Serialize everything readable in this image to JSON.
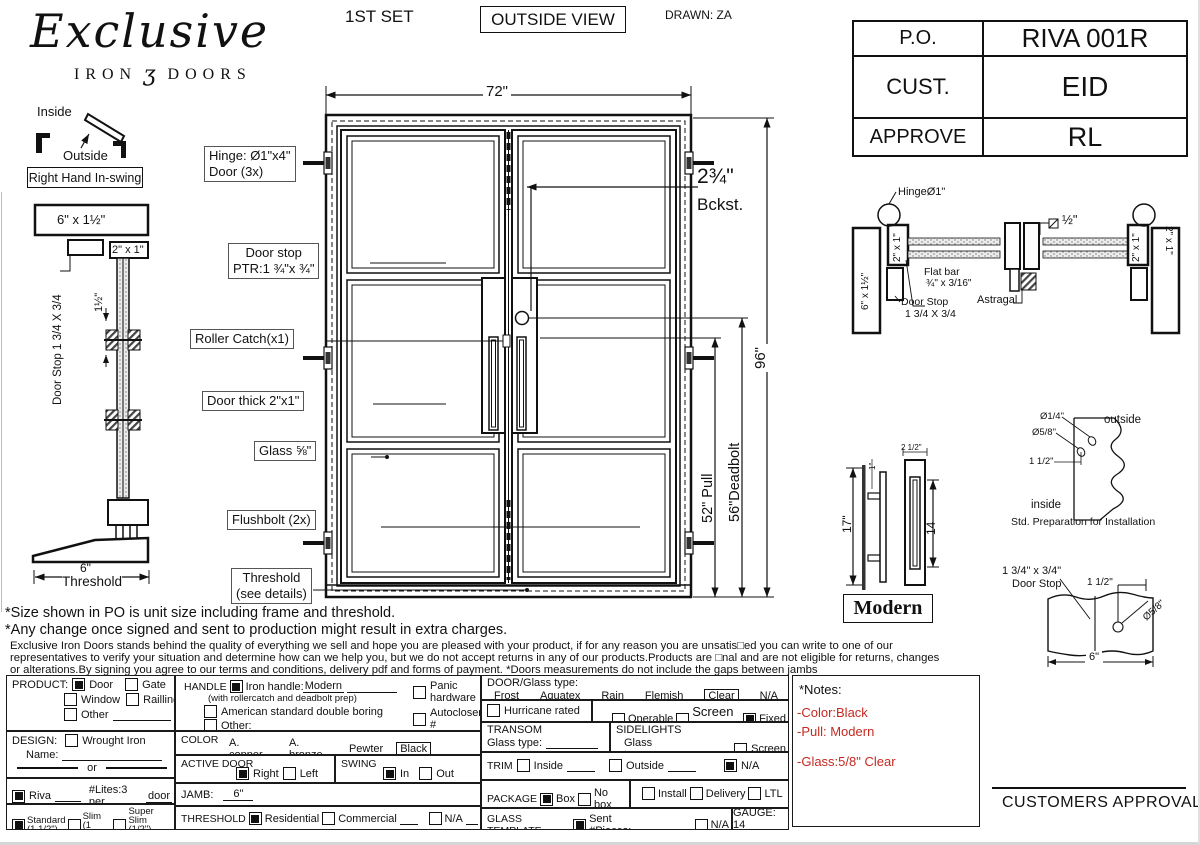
{
  "colors": {
    "accent_red": "#c52a21",
    "ink": "#111111"
  },
  "logo": {
    "name": "Exclusive",
    "sub_left": "IRON",
    "sub_glyph": "ʒ",
    "sub_right": "DOORS"
  },
  "header": {
    "set": "1ST SET",
    "view": "OUTSIDE VIEW",
    "drawn": "DRAWN: ZA"
  },
  "order_table": {
    "rows": [
      {
        "label": "P.O.",
        "value": "RIVA 001R"
      },
      {
        "label": "CUST.",
        "value": "EID"
      },
      {
        "label": "APPROVE",
        "value": "RL"
      }
    ]
  },
  "swing_diagram": {
    "inside": "Inside",
    "outside": "Outside",
    "caption": "Right Hand In-swing"
  },
  "side_profile": {
    "head_dim": "6\" x 1½\"",
    "stile_dim": "2\" x 1\"",
    "door_stop": "Door Stop 1 3/4 X 3/4",
    "stop_gap": "1½\"",
    "threshold_width": "6\"",
    "threshold_label": "Threshold"
  },
  "elevation": {
    "width": "72\"",
    "height": "96\"",
    "pull": "52\" Pull",
    "deadbolt": "56\"Deadbolt",
    "backset_value": "2¾\"",
    "backset_label": "Bckst.",
    "callouts": {
      "hinge_line1": "Hinge: Ø1\"x4\"",
      "hinge_line2": "Door (3x)",
      "door_stop_line1": "Door stop",
      "door_stop_line2": "PTR:1 ¾\"x ¾\"",
      "roller_catch": "Roller Catch(x1)",
      "door_thickness": "Door thick 2\"x1\"",
      "glass": "Glass ⅝\"",
      "flushbolt": "Flushbolt (2x)",
      "threshold_line1": "Threshold",
      "threshold_line2": "(see details)"
    }
  },
  "head_detail": {
    "hinge": "HingeØ1\"",
    "left_jamb": "6\" x 1½\"",
    "left_stile": "2\" x 1\"",
    "right_stile": "2\" x 1\"",
    "right_jamb": "2\" x 1\"",
    "gap": "½\"",
    "flat_bar_line1": "Flat bar",
    "flat_bar_line2": "¾\" x 3/16\"",
    "door_stop_line1": "Door Stop",
    "door_stop_line2": "1 3/4 X 3/4",
    "astragal": "Astragal"
  },
  "pull_detail": {
    "height": "17\"",
    "slot_height": "14",
    "width": "2 1/2\"",
    "standoff": "1\"",
    "style": "Modern"
  },
  "prep_detail": {
    "hole_small": "Ø1/4\"",
    "hole_large": "Ø5/8\"",
    "offset": "1 1/2\"",
    "outside": "outside",
    "inside": "inside",
    "caption": "Std. Preparation for Installation"
  },
  "stop_detail": {
    "size": "1 3/4\" x 3/4\"",
    "name": "Door Stop",
    "offset": "1 1/2\"",
    "hole": "Ø5/8\"",
    "width": "6\""
  },
  "disclaimers": {
    "line1": "*Size shown in PO is unit size including frame and threshold.",
    "line2": "*Any change once signed and sent to production might result in extra charges.",
    "para_line1": "Exclusive Iron Doors stands behind the quality of everything we sell and hope you are pleased with your product, if for any reason you are unsatis□ed you can write to one of our",
    "para_line2": "representatives to verify your situation and determine how can we help you, but we do not accept returns in any of our products.Products are □nal and are not eligible for returns, changes",
    "para_line3": "or alterations.By signing you agree to our terms and conditions, delivery pdf and forms of payment. *Doors measurements do not include the gaps between jambs"
  },
  "form": {
    "product": {
      "label": "PRODUCT:",
      "door": {
        "label": "Door",
        "checked": true
      },
      "gate": {
        "label": "Gate",
        "checked": false
      },
      "window": {
        "label": "Window",
        "checked": false
      },
      "railing": {
        "label": "Railling",
        "checked": false
      },
      "other": {
        "label": "Other",
        "checked": false
      }
    },
    "design": {
      "label": "DESIGN:",
      "wrought": {
        "label": "Wrought Iron",
        "checked": false
      },
      "name_label": "Name:",
      "or_label": "or"
    },
    "riva": {
      "check": {
        "label": "Riva",
        "checked": true
      },
      "lites": "#Lites:3 per",
      "lites_ul": "door"
    },
    "profile": {
      "standard": {
        "label": "Standard",
        "sub": "(1 1/2\")",
        "checked": true
      },
      "slim": {
        "label": "Slim",
        "sub": "(1 1/4\")",
        "checked": false
      },
      "super_slim": {
        "label": "Super Slim",
        "sub": "(1/2\") SDL",
        "checked": false
      }
    },
    "handle": {
      "label": "HANDLE",
      "iron": {
        "label": "Iron handle:",
        "value": "Modern",
        "checked": true
      },
      "note": "(with rollercatch and deadbolt prep)",
      "american": {
        "label": "American standard double boring",
        "checked": false
      },
      "other": {
        "label": "Other:",
        "checked": false
      },
      "panic": {
        "label": "Panic hardware",
        "checked": false
      },
      "autocloser": {
        "label": "Autocloser #",
        "checked": false
      },
      "pbar": {
        "label": "P. Bar #",
        "checked": false
      }
    },
    "color": {
      "label": "COLOR",
      "opt1": "A. copper",
      "opt2": "A. bronze",
      "opt3": "Pewter",
      "selected": "Black"
    },
    "active_door": {
      "label": "ACTIVE DOOR",
      "right": {
        "label": "Right",
        "checked": true
      },
      "left": {
        "label": "Left",
        "checked": false
      }
    },
    "swing": {
      "label": "SWING",
      "in": {
        "label": "In",
        "checked": true
      },
      "out": {
        "label": "Out",
        "checked": false
      }
    },
    "jamb": {
      "label": "JAMB:",
      "value": "6\""
    },
    "threshold": {
      "label": "THRESHOLD",
      "residential": {
        "label": "Residential",
        "checked": true
      },
      "commercial": {
        "label": "Commercial",
        "checked": false
      },
      "na": {
        "label": "N/A",
        "checked": false
      }
    },
    "glass_type": {
      "label": "DOOR/Glass type:",
      "opt1": "Frost",
      "opt2": "Aquatex",
      "opt3": "Rain",
      "opt4": "Flemish",
      "selected": "Clear",
      "opt6": "N/A"
    },
    "hurricane": {
      "label": "Hurricane rated",
      "checked": false
    },
    "operable": {
      "label": "Operable",
      "checked": false
    },
    "screen_or": {
      "label": "Screen or",
      "checked": false
    },
    "fixed": {
      "label": "Fixed",
      "checked": true
    },
    "transom": {
      "label": "TRANSOM",
      "glass_label": "Glass type:"
    },
    "sidelights": {
      "label": "SIDELIGHTS",
      "glass_label": "Glass type:",
      "screen": {
        "label": "Screen",
        "checked": false
      }
    },
    "trim": {
      "label": "TRIM",
      "inside": {
        "label": "Inside",
        "checked": false
      },
      "outside": {
        "label": "Outside",
        "checked": false
      },
      "na": {
        "label": "N/A",
        "checked": true
      }
    },
    "package": {
      "label": "PACKAGE",
      "box": {
        "label": "Box",
        "checked": true
      },
      "nobox": {
        "label": "No box",
        "checked": false
      },
      "install": {
        "label": "Install",
        "checked": false
      },
      "delivery": {
        "label": "Delivery",
        "checked": false
      },
      "ltl": {
        "label": "LTL",
        "checked": false
      }
    },
    "glass_template": {
      "label": "GLASS TEMPLATE",
      "sent": {
        "label": "Sent #Pieces:",
        "checked": true
      },
      "na": {
        "label": "N/A",
        "checked": false
      }
    },
    "gauge": "GAUGE: 14"
  },
  "notes_box": {
    "title": "*Notes:",
    "item1": "-Color:Black",
    "item2": "-Pull: Modern",
    "item3": "-Glass:5/8\" Clear"
  },
  "approval": {
    "label": "CUSTOMERS APPROVAL"
  }
}
